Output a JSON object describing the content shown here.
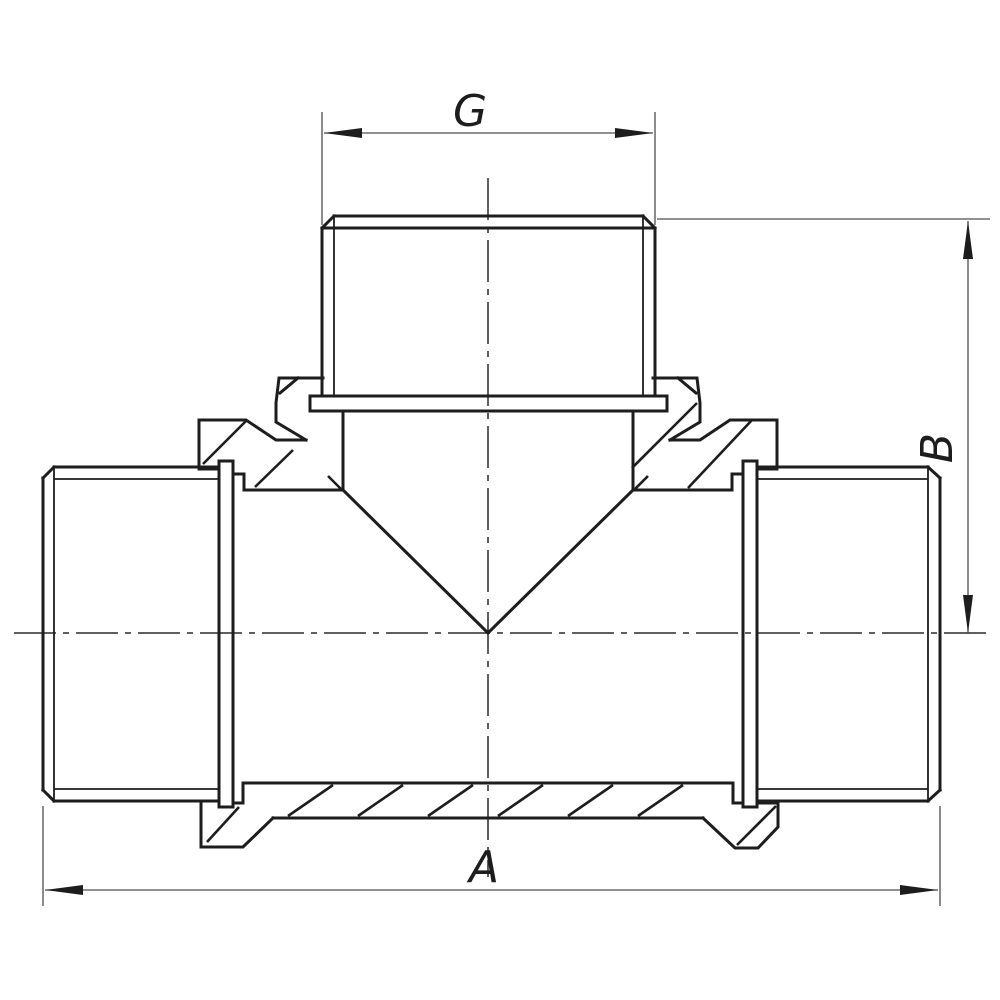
{
  "drawing": {
    "type": "technical-section-drawing",
    "subject": "threaded pipe tee fitting, front section view",
    "colors": {
      "background": "#ffffff",
      "object_line": "#1d1d1d",
      "dimension_line": "#4f4f4f",
      "center_line": "#2a2a2a"
    },
    "dimensions": {
      "top": {
        "label": "G"
      },
      "bottom": {
        "label": "A"
      },
      "right": {
        "label": "B"
      }
    }
  }
}
